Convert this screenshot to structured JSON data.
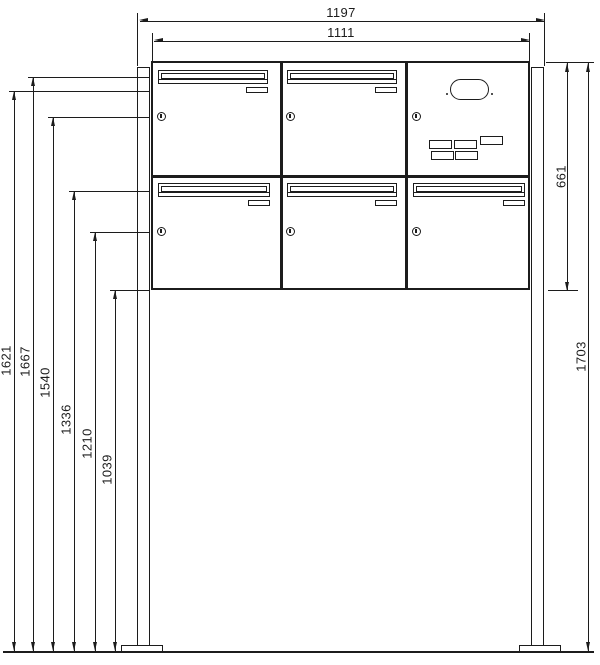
{
  "dimensions": {
    "overall_width": "1197",
    "cabinet_width": "1111",
    "cabinet_height": "661",
    "post_height": "1703",
    "height_marks": [
      "1621",
      "1667",
      "1540",
      "1336",
      "1210",
      "1039"
    ]
  },
  "colors": {
    "line": "#1c1c1c",
    "background": "#ffffff"
  }
}
